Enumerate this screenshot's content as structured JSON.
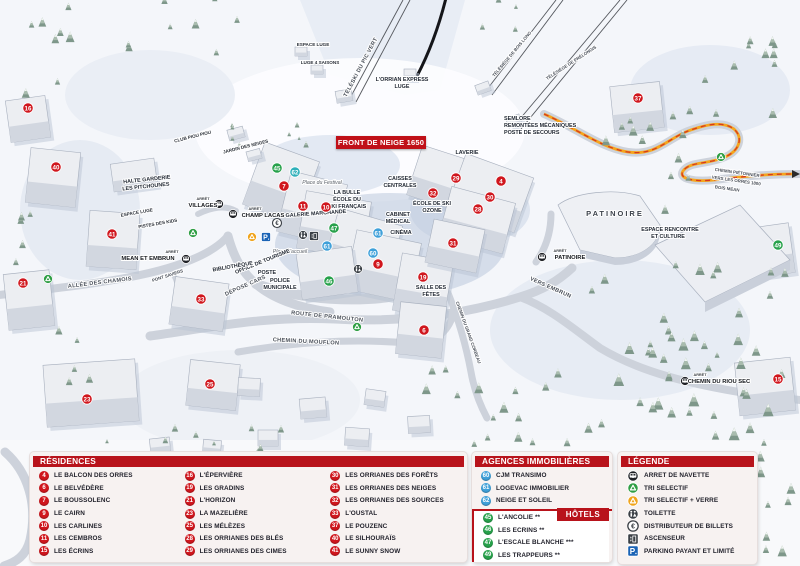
{
  "title_banner": "FRONT DE NEIGE 1650",
  "colors": {
    "red": "#d0161d",
    "green": "#27a14b",
    "blue": "#3fa0d9",
    "teal": "#2fb0ba",
    "header": "#b8131b",
    "parking": "#1a63b5"
  },
  "map": {
    "markers": [
      {
        "n": "16",
        "x": 28,
        "y": 108,
        "c": "red"
      },
      {
        "n": "40",
        "x": 56,
        "y": 167,
        "c": "red"
      },
      {
        "n": "41",
        "x": 112,
        "y": 234,
        "c": "red"
      },
      {
        "n": "21",
        "x": 23,
        "y": 283,
        "c": "red"
      },
      {
        "n": "33",
        "x": 201,
        "y": 299,
        "c": "red"
      },
      {
        "n": "23",
        "x": 87,
        "y": 399,
        "c": "red"
      },
      {
        "n": "25",
        "x": 210,
        "y": 384,
        "c": "red"
      },
      {
        "n": "7",
        "x": 284,
        "y": 186,
        "c": "red"
      },
      {
        "n": "11",
        "x": 303,
        "y": 206,
        "c": "red"
      },
      {
        "n": "10",
        "x": 326,
        "y": 207,
        "c": "red"
      },
      {
        "n": "9",
        "x": 378,
        "y": 264,
        "c": "red"
      },
      {
        "n": "19",
        "x": 423,
        "y": 277,
        "c": "red"
      },
      {
        "n": "6",
        "x": 424,
        "y": 330,
        "c": "red"
      },
      {
        "n": "29",
        "x": 456,
        "y": 178,
        "c": "red"
      },
      {
        "n": "32",
        "x": 433,
        "y": 193,
        "c": "red"
      },
      {
        "n": "4",
        "x": 501,
        "y": 181,
        "c": "red"
      },
      {
        "n": "30",
        "x": 490,
        "y": 197,
        "c": "red"
      },
      {
        "n": "28",
        "x": 478,
        "y": 209,
        "c": "red"
      },
      {
        "n": "31",
        "x": 453,
        "y": 243,
        "c": "red"
      },
      {
        "n": "37",
        "x": 638,
        "y": 98,
        "c": "red"
      },
      {
        "n": "15",
        "x": 778,
        "y": 379,
        "c": "red"
      },
      {
        "n": "45",
        "x": 277,
        "y": 168,
        "c": "green"
      },
      {
        "n": "47",
        "x": 334,
        "y": 228,
        "c": "green"
      },
      {
        "n": "46",
        "x": 329,
        "y": 281,
        "c": "green"
      },
      {
        "n": "49",
        "x": 778,
        "y": 245,
        "c": "green"
      },
      {
        "n": "62",
        "x": 295,
        "y": 172,
        "c": "teal"
      },
      {
        "n": "61",
        "x": 327,
        "y": 246,
        "c": "blue"
      },
      {
        "n": "61",
        "x": 378,
        "y": 233,
        "c": "blue"
      },
      {
        "n": "60",
        "x": 373,
        "y": 253,
        "c": "blue"
      }
    ],
    "labels": [
      {
        "t": "L'ORRIAN EXPRESS",
        "x": 402,
        "y": 81,
        "cls": "bld"
      },
      {
        "t": "LUGE",
        "x": 402,
        "y": 88,
        "cls": "bld"
      },
      {
        "t": "TÉLÉSKI DU PIC VERT",
        "x": 362,
        "y": 68,
        "r": -62,
        "cls": "road"
      },
      {
        "t": "TÉLÉSIÈGE DE BOIS LONG",
        "x": 513,
        "y": 55,
        "r": -50,
        "cls": "tinyroad"
      },
      {
        "t": "TÉLÉSIÈGE DE PRÉLONGIS",
        "x": 572,
        "y": 64,
        "r": -33,
        "cls": "tinyroad"
      },
      {
        "t": "SEMLORE",
        "x": 504,
        "y": 120,
        "cls": "bldL"
      },
      {
        "t": "REMONTÉES MÉCANIQUES",
        "x": 504,
        "y": 127,
        "cls": "bldL"
      },
      {
        "t": "POSTE DE SECOURS",
        "x": 504,
        "y": 134,
        "cls": "bldL"
      },
      {
        "t": "ESPACE LUGE",
        "x": 313,
        "y": 46,
        "cls": "box"
      },
      {
        "t": "LUGE 4 SAISONS",
        "x": 320,
        "y": 64,
        "cls": "box"
      },
      {
        "t": "CLUB PIOU PIOU",
        "x": 193,
        "y": 138,
        "r": -14,
        "cls": "box"
      },
      {
        "t": "JARDIN DES NEIGES",
        "x": 246,
        "y": 148,
        "r": -14,
        "cls": "box"
      },
      {
        "t": "HALTE GARDERIE",
        "x": 147,
        "y": 181,
        "r": -6,
        "cls": "bld"
      },
      {
        "t": "LES PITCHOUNES",
        "x": 146,
        "y": 188,
        "r": -6,
        "cls": "bld"
      },
      {
        "t": "ESPACE LUGE",
        "x": 137,
        "y": 214,
        "r": -10,
        "cls": "box"
      },
      {
        "t": "PISTES DES KIDS",
        "x": 158,
        "y": 225,
        "r": -10,
        "cls": "box"
      },
      {
        "t": "ARRÊT",
        "x": 203,
        "y": 200,
        "cls": "tiny"
      },
      {
        "t": "VILLAGES",
        "x": 203,
        "y": 207,
        "cls": "stop"
      },
      {
        "t": "ARRÊT",
        "x": 255,
        "y": 210,
        "cls": "tiny"
      },
      {
        "t": "CHAMP LACAS",
        "x": 263,
        "y": 217,
        "cls": "stop"
      },
      {
        "t": "ARRÊT",
        "x": 172,
        "y": 253,
        "cls": "tiny"
      },
      {
        "t": "MEAN ET EMBRUN",
        "x": 148,
        "y": 260,
        "cls": "stop"
      },
      {
        "t": "ARRÊT",
        "x": 560,
        "y": 252,
        "cls": "tiny"
      },
      {
        "t": "PATINOIRE",
        "x": 570,
        "y": 259,
        "cls": "stop"
      },
      {
        "t": "ARRÊT",
        "x": 700,
        "y": 376,
        "cls": "tiny"
      },
      {
        "t": "CHEMIN DU RIOU SEC",
        "x": 719,
        "y": 383,
        "cls": "stop"
      },
      {
        "t": "Place du Festival",
        "x": 322,
        "y": 184,
        "cls": "place"
      },
      {
        "t": "LA BULLE",
        "x": 347,
        "y": 194,
        "cls": "bld"
      },
      {
        "t": "ÉCOLE DU",
        "x": 347,
        "y": 201,
        "cls": "bld"
      },
      {
        "t": "SKI FRANÇAIS",
        "x": 347,
        "y": 208,
        "cls": "bld"
      },
      {
        "t": "GALERIE MARCHANDE",
        "x": 316,
        "y": 215,
        "r": -4,
        "cls": "bld"
      },
      {
        "t": "CAISSES",
        "x": 400,
        "y": 180,
        "cls": "bld"
      },
      {
        "t": "CENTRALES",
        "x": 400,
        "y": 187,
        "cls": "bld"
      },
      {
        "t": "LAVERIE",
        "x": 467,
        "y": 154,
        "cls": "bld"
      },
      {
        "t": "ÉCOLE DE SKI",
        "x": 432,
        "y": 205,
        "cls": "bld"
      },
      {
        "t": "OZONE",
        "x": 432,
        "y": 212,
        "cls": "bld"
      },
      {
        "t": "CABINET",
        "x": 398,
        "y": 216,
        "cls": "bld"
      },
      {
        "t": "MÉDICAL",
        "x": 398,
        "y": 223,
        "cls": "bld"
      },
      {
        "t": "CINÉMA",
        "x": 401,
        "y": 234,
        "cls": "bld"
      },
      {
        "t": "Place d'accueil",
        "x": 290,
        "y": 253,
        "cls": "place"
      },
      {
        "t": "OFFICE DE TOURISME",
        "x": 263,
        "y": 263,
        "r": -22,
        "cls": "bld"
      },
      {
        "t": "BIBLIOTHÈQUE",
        "x": 233,
        "y": 268,
        "r": -10,
        "cls": "bld"
      },
      {
        "t": "POSTE",
        "x": 267,
        "y": 274,
        "cls": "bld"
      },
      {
        "t": "POLICE",
        "x": 280,
        "y": 282,
        "cls": "bld"
      },
      {
        "t": "MUNICIPALE",
        "x": 280,
        "y": 289,
        "cls": "bld"
      },
      {
        "t": "DÉPOSE CARS",
        "x": 246,
        "y": 287,
        "r": -24,
        "cls": "road"
      },
      {
        "t": "SALLE DES",
        "x": 431,
        "y": 289,
        "cls": "bld"
      },
      {
        "t": "FÊTES",
        "x": 431,
        "y": 296,
        "cls": "bld"
      },
      {
        "t": "ALLÉE DES CHAMOIS",
        "x": 100,
        "y": 284,
        "r": -7,
        "cls": "road"
      },
      {
        "t": "PONT SAVIERS",
        "x": 168,
        "y": 277,
        "r": -18,
        "cls": "tinyroad"
      },
      {
        "t": "ROUTE DE PRAMOUTON",
        "x": 327,
        "y": 318,
        "r": 6,
        "cls": "road"
      },
      {
        "t": "CHEMIN DU MOUFLON",
        "x": 306,
        "y": 343,
        "r": 3,
        "cls": "road"
      },
      {
        "t": "CHEMIN DU GRAND CORBEAU",
        "x": 467,
        "y": 333,
        "r": 70,
        "cls": "tinyroad"
      },
      {
        "t": "VERS EMBRUN",
        "x": 550,
        "y": 289,
        "r": 24,
        "cls": "road"
      },
      {
        "t": "PATINOIRE",
        "x": 615,
        "y": 216,
        "cls": "big"
      },
      {
        "t": "ESPACE RENCONTRE",
        "x": 670,
        "y": 231,
        "cls": "bld"
      },
      {
        "t": "ET CULTURE",
        "x": 668,
        "y": 238,
        "cls": "bld"
      },
      {
        "t": "CHEMIN PIÉTONNIER",
        "x": 737,
        "y": 174,
        "r": 8,
        "cls": "tinyroad"
      },
      {
        "t": "VERS LES ORRES 1800",
        "x": 736,
        "y": 182,
        "r": 8,
        "cls": "tinyroad"
      },
      {
        "t": "BOIS MÉAN",
        "x": 727,
        "y": 190,
        "r": 8,
        "cls": "tinyroad"
      }
    ],
    "icons": [
      {
        "type": "bus",
        "x": 219,
        "y": 204
      },
      {
        "type": "bus",
        "x": 233,
        "y": 214
      },
      {
        "type": "bus",
        "x": 186,
        "y": 259
      },
      {
        "type": "bus",
        "x": 542,
        "y": 257
      },
      {
        "type": "bus",
        "x": 685,
        "y": 381
      },
      {
        "type": "recycle-green",
        "x": 193,
        "y": 233
      },
      {
        "type": "recycle-green",
        "x": 48,
        "y": 279
      },
      {
        "type": "recycle-green",
        "x": 357,
        "y": 327
      },
      {
        "type": "recycle-green",
        "x": 721,
        "y": 157
      },
      {
        "type": "recycle-yellow",
        "x": 252,
        "y": 237
      },
      {
        "type": "parking",
        "x": 266,
        "y": 237
      },
      {
        "type": "euro",
        "x": 277,
        "y": 223
      },
      {
        "type": "toilets",
        "x": 303,
        "y": 235
      },
      {
        "type": "toilets",
        "x": 358,
        "y": 269
      },
      {
        "type": "elevator",
        "x": 314,
        "y": 236
      }
    ]
  },
  "panels": {
    "residences": {
      "title": "RÉSIDENCES",
      "columns": [
        [
          {
            "n": "4",
            "label": "LE BALCON DES ORRES"
          },
          {
            "n": "6",
            "label": "LE BELVÉDÈRE"
          },
          {
            "n": "7",
            "label": "LE BOUSSOLENC"
          },
          {
            "n": "9",
            "label": "LE CAIRN"
          },
          {
            "n": "10",
            "label": "LES CARLINES"
          },
          {
            "n": "11",
            "label": "LES CEMBROS"
          },
          {
            "n": "15",
            "label": "LES ÉCRINS"
          }
        ],
        [
          {
            "n": "16",
            "label": "L'ÉPERVIÈRE"
          },
          {
            "n": "19",
            "label": "LES GRADINS"
          },
          {
            "n": "21",
            "label": "L'HORIZON"
          },
          {
            "n": "23",
            "label": "LA MAZELIÈRE"
          },
          {
            "n": "25",
            "label": "LES MÉLÈZES"
          },
          {
            "n": "28",
            "label": "LES ORRIANES DES BLÉS"
          },
          {
            "n": "29",
            "label": "LES ORRIANES DES CIMES"
          }
        ],
        [
          {
            "n": "30",
            "label": "LES ORRIANES DES FORÊTS"
          },
          {
            "n": "31",
            "label": "LES ORRIANES DES NEIGES"
          },
          {
            "n": "32",
            "label": "LES ORRIANES DES SOURCES"
          },
          {
            "n": "33",
            "label": "L'OUSTAL"
          },
          {
            "n": "37",
            "label": "LE POUZENC"
          },
          {
            "n": "40",
            "label": "LE SILHOURAÏS"
          },
          {
            "n": "41",
            "label": "LE SUNNY SNOW"
          }
        ]
      ]
    },
    "agences": {
      "title": "AGENCES IMMOBILIÈRES",
      "items": [
        {
          "n": "60",
          "label": "CJM TRANSIMO"
        },
        {
          "n": "61",
          "label": "LOGEVAC IMMOBILIER"
        },
        {
          "n": "62",
          "label": "NEIGE ET SOLEIL"
        }
      ]
    },
    "hotels": {
      "title": "HÔTELS",
      "items": [
        {
          "n": "45",
          "label": "L'ANCOLIE **"
        },
        {
          "n": "46",
          "label": "LES ECRINS **"
        },
        {
          "n": "47",
          "label": "L'ESCALE BLANCHE ***"
        },
        {
          "n": "49",
          "label": "LES TRAPPEURS **"
        }
      ]
    },
    "legende": {
      "title": "LÉGENDE",
      "items": [
        {
          "icon": "bus",
          "label": "ARRET DE NAVETTE"
        },
        {
          "icon": "recycle-green",
          "label": "TRI SELECTIF"
        },
        {
          "icon": "recycle-yellow",
          "label": "TRI SELECTIF + VERRE"
        },
        {
          "icon": "toilets",
          "label": "TOILETTE"
        },
        {
          "icon": "euro",
          "label": "DISTRIBUTEUR DE BILLETS"
        },
        {
          "icon": "elevator",
          "label": "ASCENSEUR"
        },
        {
          "icon": "parking",
          "label": "PARKING PAYANT ET LIMITÉ"
        }
      ]
    }
  }
}
